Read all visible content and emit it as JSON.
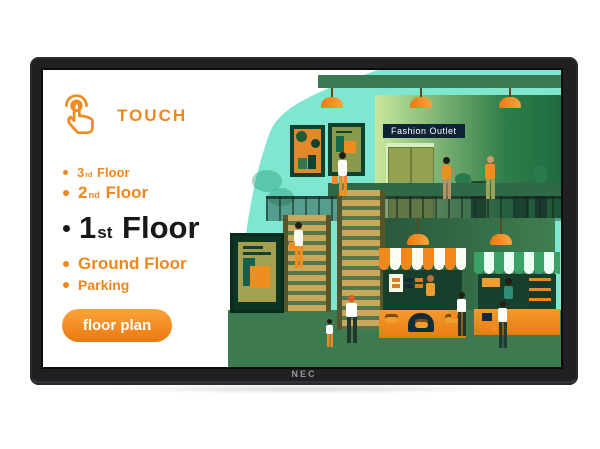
{
  "monitor": {
    "brand_label": "NEC"
  },
  "screen": {
    "touch": {
      "label": "TOUCH",
      "icon": "hand-tap-icon"
    },
    "floors": [
      {
        "prefix": "3",
        "ordinal": "rd",
        "name": "Floor"
      },
      {
        "prefix": "2",
        "ordinal": "nd",
        "name": "Floor"
      },
      {
        "prefix": "1",
        "ordinal": "st",
        "name": "Floor"
      },
      {
        "prefix": "",
        "ordinal": "",
        "name": "Ground Floor"
      },
      {
        "prefix": "",
        "ordinal": "",
        "name": "Parking"
      }
    ],
    "floor_plan_button": {
      "label": "floor plan"
    },
    "illustration": {
      "store_sign": "Fashion Outlet",
      "colors": {
        "mint": "#7FE7CF",
        "accent_orange": "#F0871D",
        "deep_green": "#173F2B",
        "mid_green": "#3D7A50",
        "ceiling_green": "#3A7A52",
        "stair_tan": "#C9A75B",
        "sign_navy": "#0E2434"
      }
    }
  },
  "colors": {
    "accent_orange": "#F0871D",
    "bezel": "#202023",
    "background": "#FFFFFF"
  }
}
